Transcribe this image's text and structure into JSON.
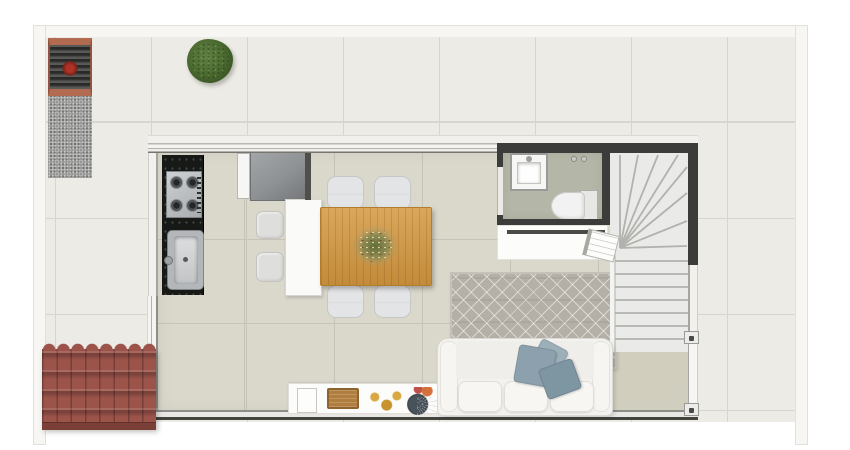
{
  "canvas": {
    "width": 850,
    "height": 450,
    "background": "#ffffff",
    "kind": "rendered floor plan, top-down view, no text labels"
  },
  "palette": {
    "plot-wall": "#f7f6f3",
    "plot-wall-edge": "#e2e0da",
    "terrace-tile": "#edebe5",
    "terrace-grout": "#d8d5ce",
    "interior-tile": "#dad7cb",
    "interior-grout": "#c7c4b7",
    "interior-tile-green": "#cfcdbc",
    "wall-white": "#f2f1ee",
    "wall-edge": "#a7a5a0",
    "wall-dark": "#3c3c3a",
    "window-glass": "#f4f4f1",
    "granite": "#171917",
    "sink-gray": "#b4b7b9",
    "fridge": "#8e9193",
    "counter-white": "#fafaf8",
    "chair": "#e3e4e5",
    "stool": "#dededc",
    "table-wood": "#d3973f",
    "table-edge": "#b27d2c",
    "plant-green": "#4c6c32",
    "plant-dark": "#35501f",
    "bath-floor": "#b4b7a7",
    "porcelain": "#f1f2f1",
    "stair-fill": "#eaeae8",
    "stair-line": "#b1b1ae",
    "rug-base": "#b5b0a7",
    "sofa": "#f3f2ee",
    "pillow-a": "#8ca1ad",
    "pillow-b": "#7e95a2",
    "pillow-c": "#9db0ba",
    "sideboard": "#fcfcfb",
    "tray-wood": "#b07f3f",
    "decor-gold": "#d9a843",
    "decor-orange": "#d4703a",
    "vase-dark": "#333b3f",
    "roof-red": "#9c544a",
    "roof-red-dark": "#7a4037",
    "pergola-frame": "#b26a50",
    "pergola-slat": "#3b3b39",
    "pergola-flower": "#b03226",
    "gravel": "#9a9a98"
  },
  "areas": {
    "outdoor": [
      "terrace",
      "pergola",
      "gravel-strip",
      "shrub",
      "entrance-roof"
    ],
    "kitchen": [
      "granite-counter",
      "gas-cooktop",
      "kitchen-sink",
      "refrigerator",
      "tall-cabinet-door",
      "island-counter",
      "stools"
    ],
    "dining": [
      "wood-dining-table",
      "dining-chairs",
      "table-centerpiece"
    ],
    "bathroom": [
      "washbasin",
      "toilet",
      "dark-partition-walls"
    ],
    "stairs": [
      "winder-staircase"
    ],
    "living": [
      "area-rug",
      "sofa",
      "throw-pillows",
      "console-sideboard",
      "white-tray",
      "wood-tray",
      "gold-decor",
      "flower-vase",
      "book"
    ],
    "shell": [
      "exterior-walls",
      "left-window",
      "top-window-wall",
      "right-door",
      "bottom-wall"
    ]
  },
  "counts": {
    "dining-chairs": 4,
    "stools": 2,
    "sofa-cushions": 3,
    "throw-pillows": 3,
    "cooktop-burners": 4
  }
}
